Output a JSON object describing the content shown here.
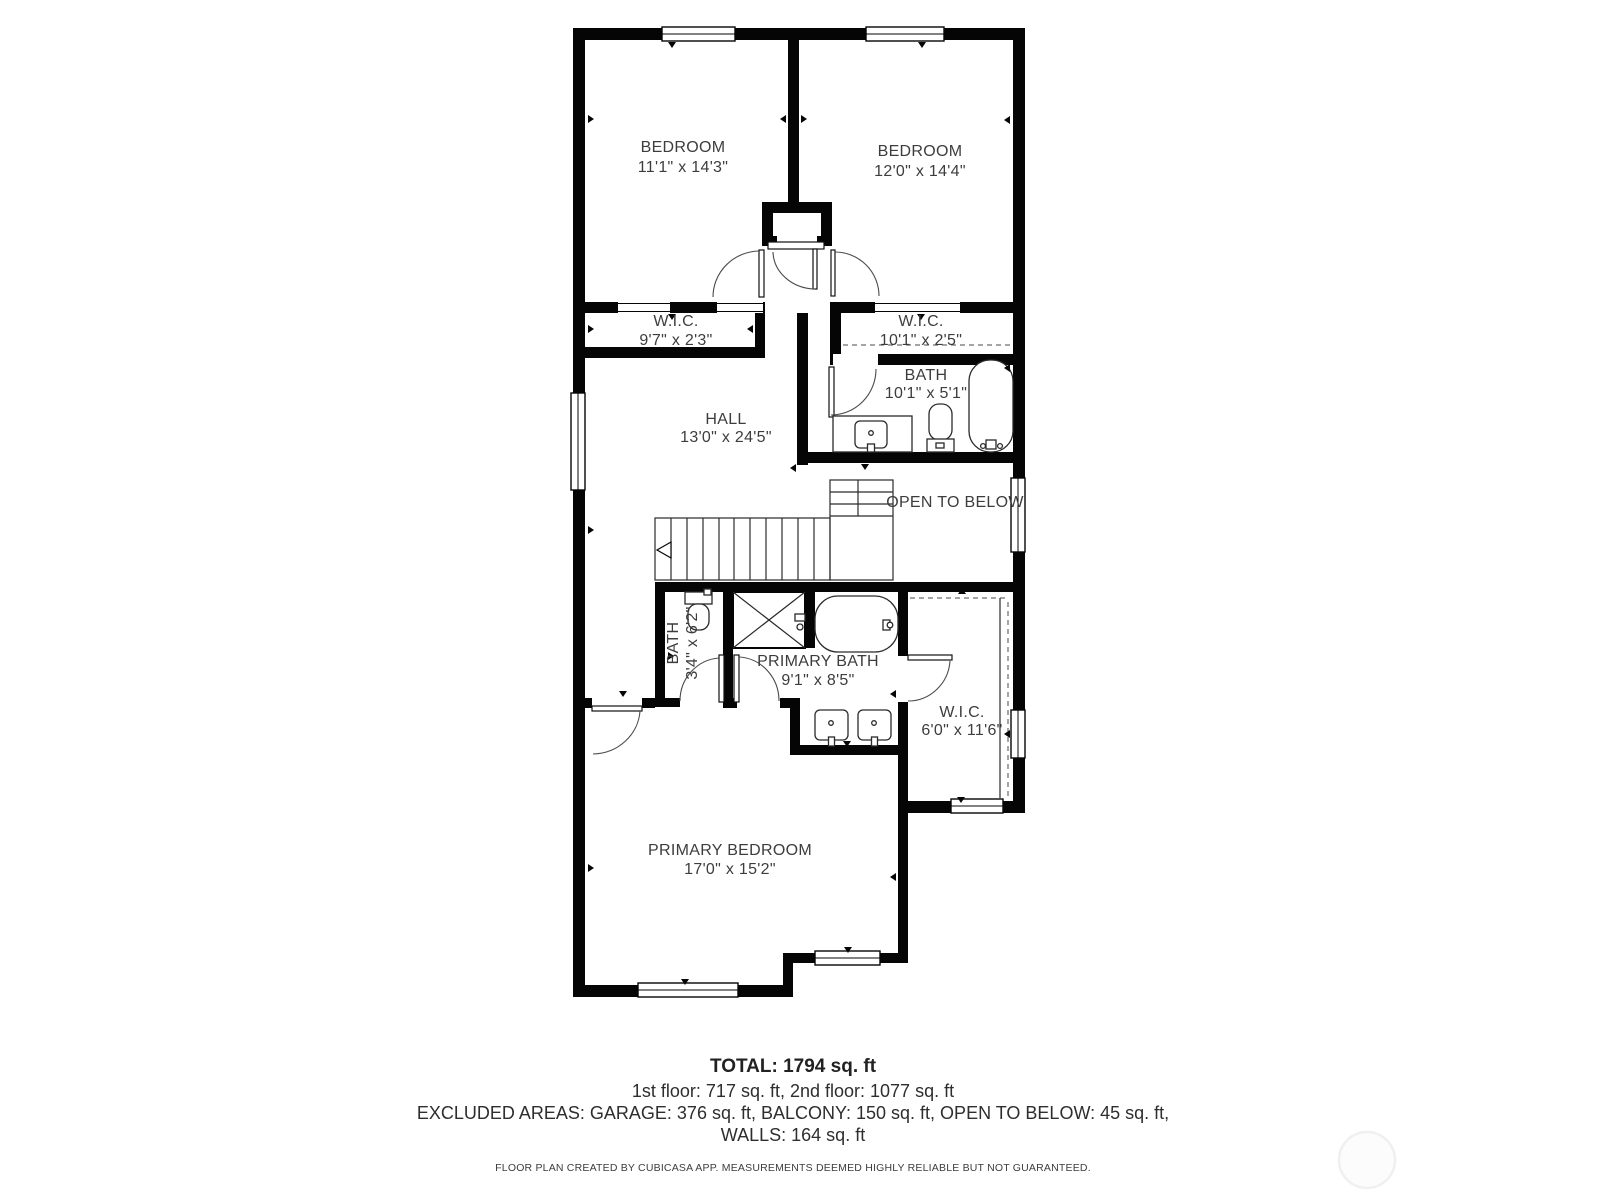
{
  "plan": {
    "rooms": {
      "bedroom1": {
        "name": "BEDROOM",
        "dims": "11'1\" x 14'3\""
      },
      "bedroom2": {
        "name": "BEDROOM",
        "dims": "12'0\" x 14'4\""
      },
      "wic_left": {
        "name": "W.I.C.",
        "dims": "9'7\" x 2'3\""
      },
      "wic_right": {
        "name": "W.I.C.",
        "dims": "10'1\" x 2'5\""
      },
      "bath": {
        "name": "BATH",
        "dims": "10'1\" x 5'1\""
      },
      "hall": {
        "name": "HALL",
        "dims": "13'0\" x 24'5\""
      },
      "open_to_below": {
        "name": "OPEN TO BELOW"
      },
      "bath_small": {
        "name": "BATH",
        "dims": "3'4\" x 6'2\""
      },
      "primary_bath": {
        "name": "PRIMARY BATH",
        "dims": "9'1\" x 8'5\""
      },
      "wic_primary": {
        "name": "W.I.C.",
        "dims": "6'0\" x 11'6\""
      },
      "primary_bedroom": {
        "name": "PRIMARY BEDROOM",
        "dims": "17'0\" x 15'2\""
      }
    },
    "footer": {
      "total": "TOTAL: 1794 sq. ft",
      "floors": "1st floor: 717 sq. ft, 2nd floor: 1077 sq. ft",
      "excluded": "EXCLUDED AREAS: GARAGE: 376 sq. ft, BALCONY: 150 sq. ft, OPEN TO BELOW: 45 sq. ft,",
      "walls": "WALLS: 164 sq. ft",
      "disclaimer": "FLOOR PLAN CREATED BY CUBICASA APP. MEASUREMENTS DEEMED HIGHLY RELIABLE BUT NOT GUARANTEED."
    },
    "colors": {
      "wall": "#050505",
      "text": "#3d3d3d",
      "background": "#ffffff"
    }
  }
}
